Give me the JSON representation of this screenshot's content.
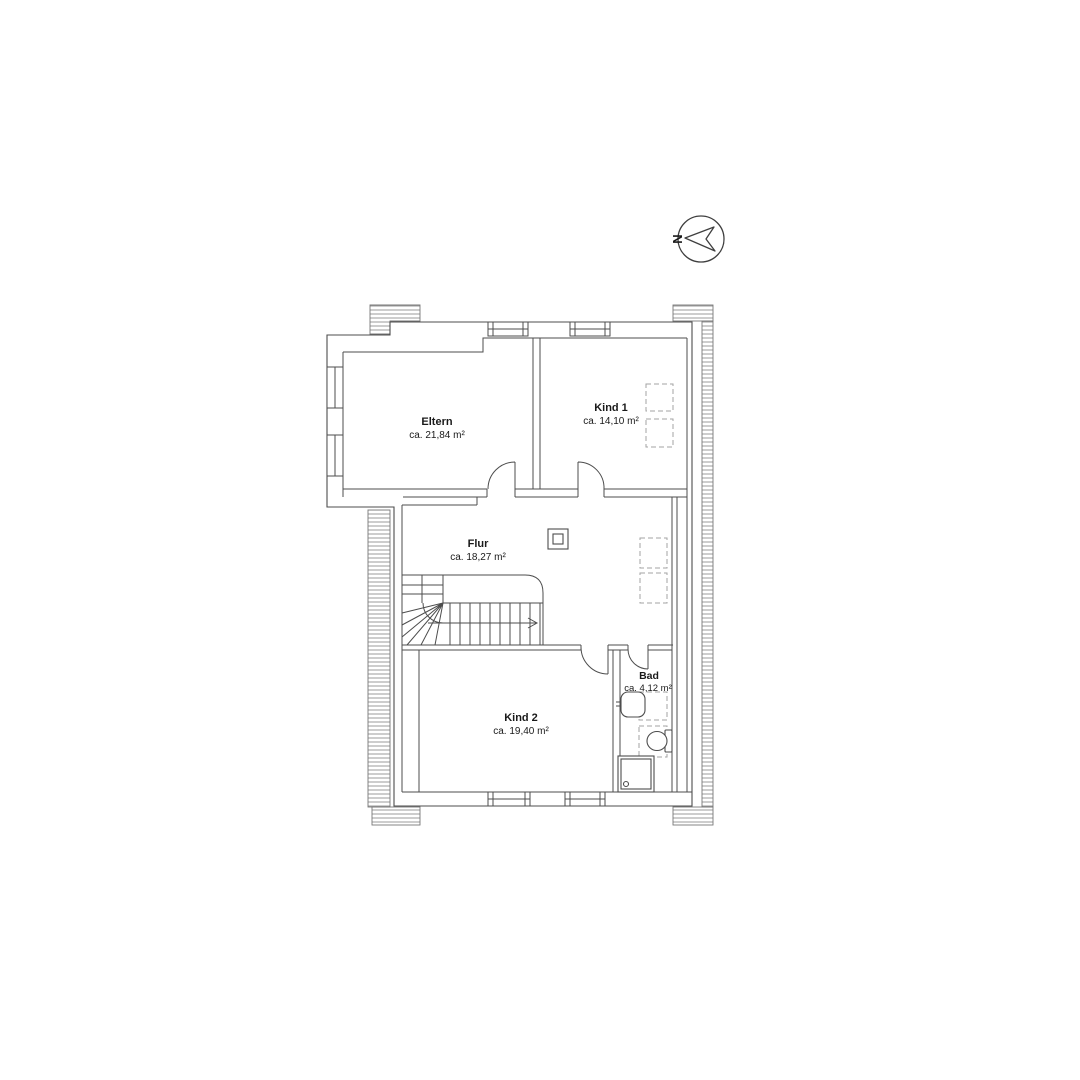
{
  "document": {
    "type": "floor-plan",
    "floor": "Dachgeschoss / upper floor"
  },
  "north_indicator": {
    "label": "N"
  },
  "rooms": [
    {
      "name": "Eltern",
      "area": "ca. 21,84 m²"
    },
    {
      "name": "Kind 1",
      "area": "ca. 14,10 m²"
    },
    {
      "name": "Flur",
      "area": "ca. 18,27 m²"
    },
    {
      "name": "Kind 2",
      "area": "ca. 19,40 m²"
    },
    {
      "name": "Bad",
      "area": "ca. 4,12 m²"
    }
  ],
  "colors": {
    "background": "#ffffff",
    "wall_line": "#4d4d4d",
    "hatch_line": "#909090",
    "dashed_line": "#a3a3a3",
    "text": "#1a1a1a"
  }
}
